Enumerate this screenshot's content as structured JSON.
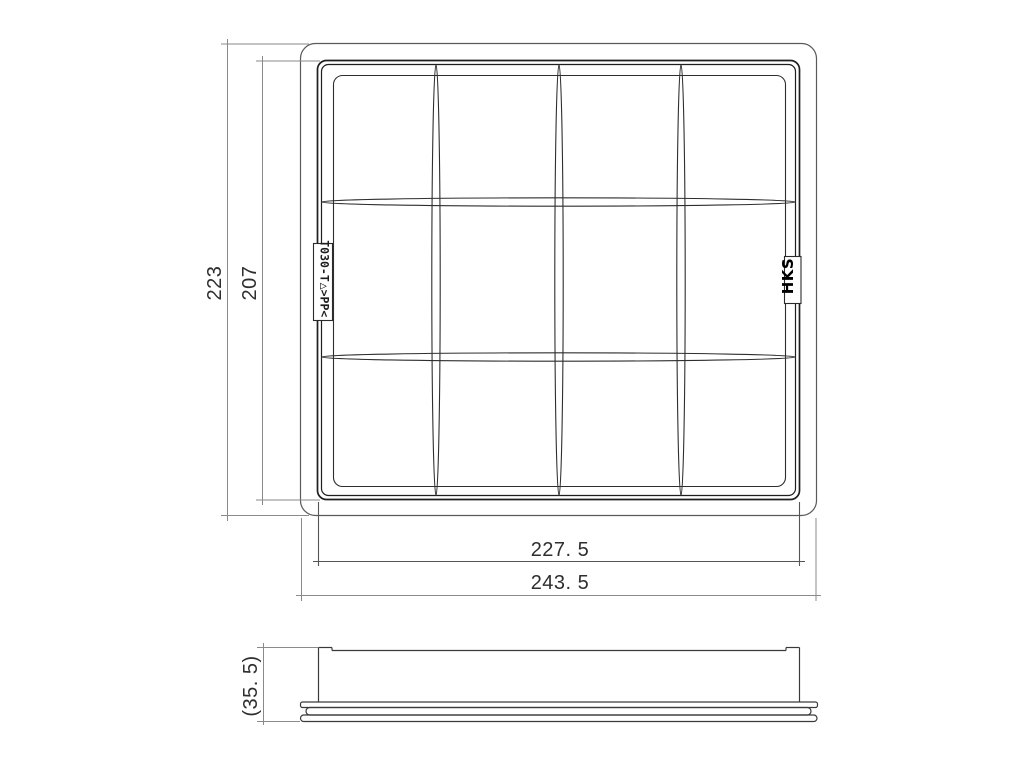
{
  "top_view": {
    "part_code": "T030-T",
    "material_mark": "△>PP<",
    "brand": "HKS",
    "dim_overall_height": "223",
    "dim_inner_height": "207",
    "dim_inner_width": "227. 5",
    "dim_overall_width": "243. 5"
  },
  "side_view": {
    "dim_height_reference": "(35. 5)"
  },
  "colors": {
    "background": "#ffffff",
    "main_outline": "#1f1f1f",
    "frame_outline": "#5a5a5a",
    "dimension_line": "#8a8a8a",
    "text": "#2e2e2e"
  }
}
